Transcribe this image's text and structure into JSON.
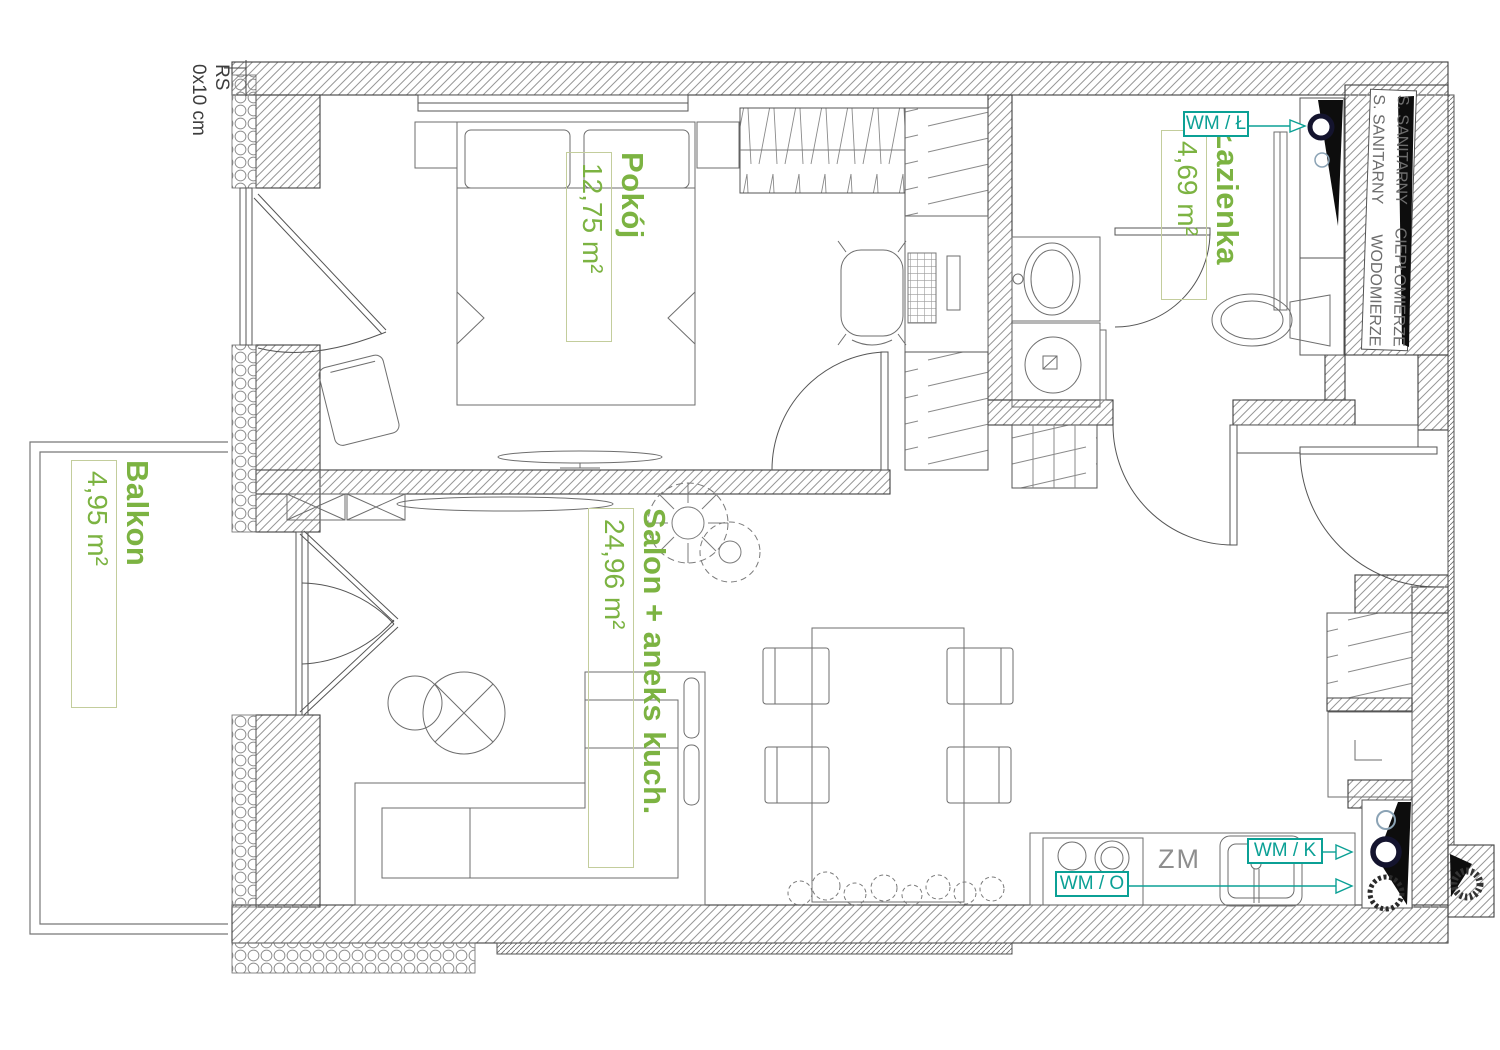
{
  "plan_labels": {
    "rooms": [
      {
        "name": "Pokój",
        "area": "12,75 m²"
      },
      {
        "name": "Łazienka",
        "area": "4,69 m²"
      },
      {
        "name": "Salon + aneks kuch.",
        "area": "24,96 m²"
      },
      {
        "name": "Balkon",
        "area": "4,95 m²"
      }
    ],
    "meters": [
      {
        "text": "WM / Ł"
      },
      {
        "text": "WM / K"
      },
      {
        "text": "WM / O"
      }
    ],
    "cold_water_label": "ZM",
    "note": {
      "line1": "RS",
      "line2": "0x10 cm"
    },
    "shaft_lines": [
      {
        "top": "S. SANITARNY",
        "bottom": "CIEPŁOMIERZE"
      },
      {
        "top": "S. SANITARNY",
        "bottom": "WODOMIERZE"
      }
    ],
    "colors": {
      "room_label": "#7cb342",
      "meter_label": "#0ba095",
      "zm_label": "#8e8e8e",
      "drawing_line": "#6e6e6e"
    }
  }
}
